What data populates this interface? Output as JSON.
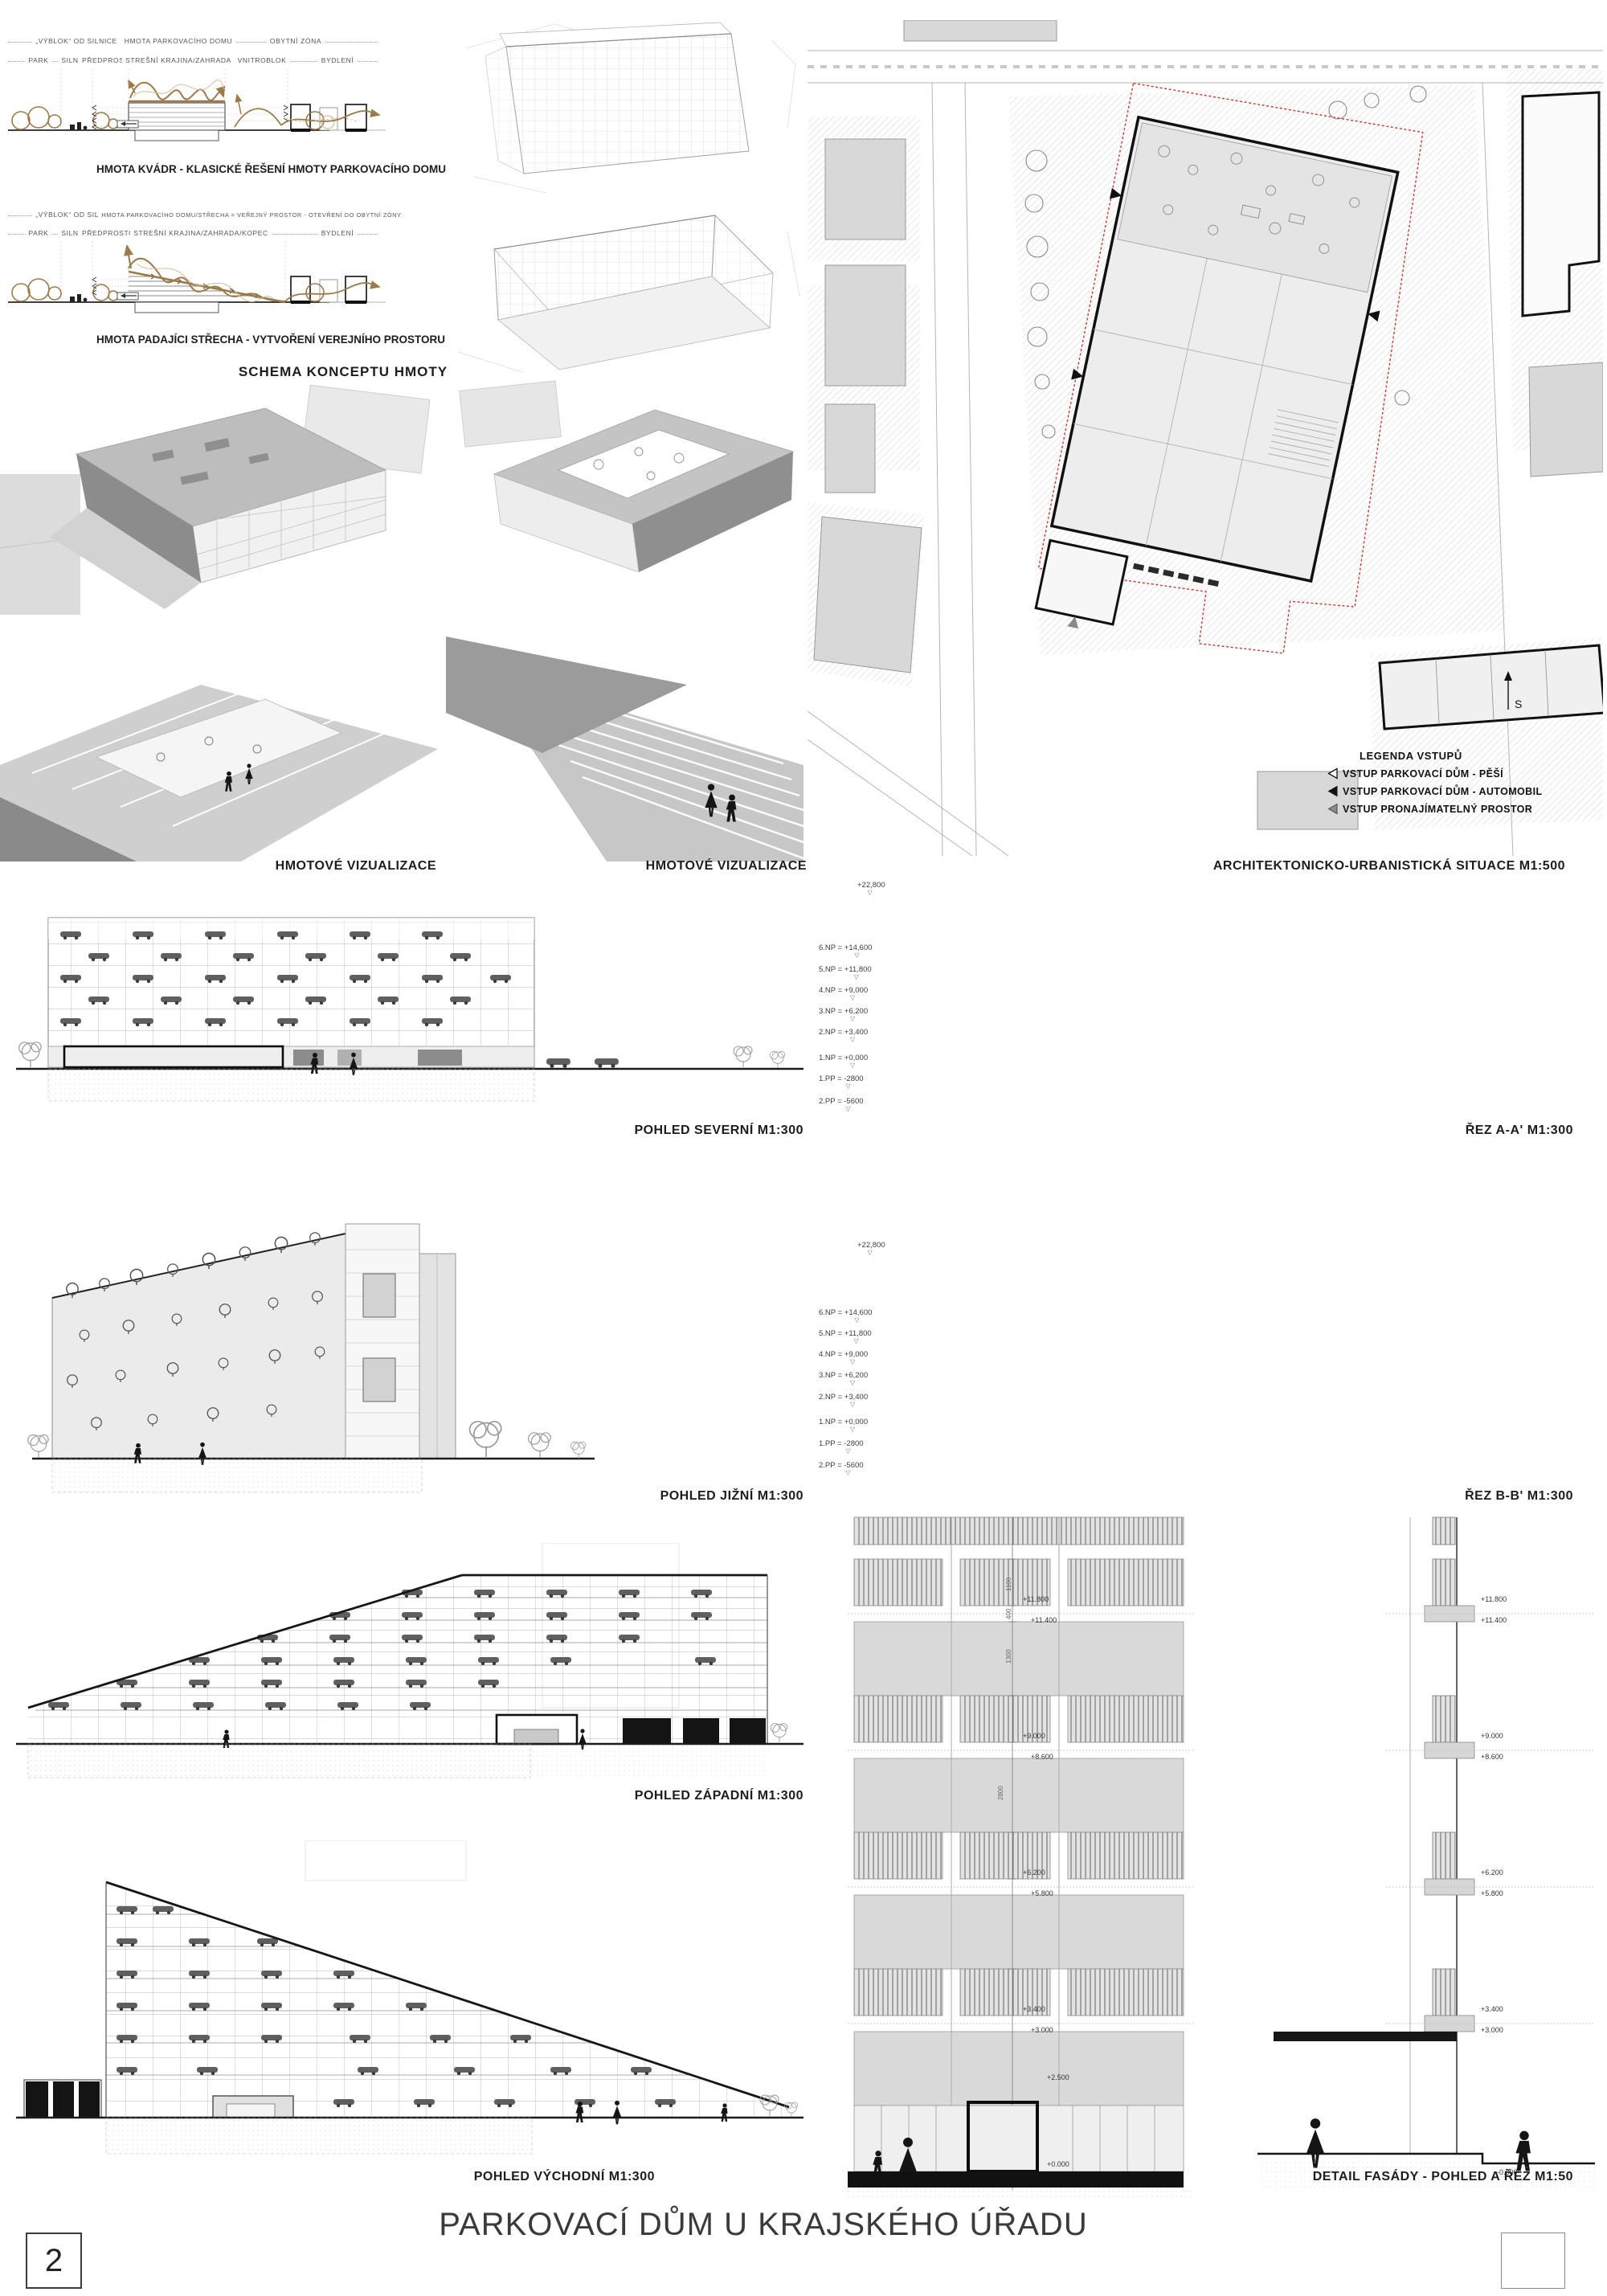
{
  "board": {
    "number": "2",
    "title": "PARKOVACÍ DŮM U KRAJSKÉHO ÚŘADU"
  },
  "concept": {
    "title": "SCHEMA KONCEPTU HMOTY",
    "diagram1": {
      "zones_top": [
        "„VÝBLOK“ OD SILNICE",
        "HMOTA PARKOVACÍHO DOMU",
        "OBYTNÍ ZÓNA"
      ],
      "zones": [
        "PARK",
        "SILNICE",
        "PŘEDPROSTOR",
        "STREŠNÍ KRAJINA/ZAHRADA",
        "VNITROBLOK",
        "BYDLENÍ"
      ],
      "caption": "HMOTA KVÁDR - KLASICKÉ ŘEŠENÍ HMOTY PARKOVACÍHO DOMU"
    },
    "diagram2": {
      "zones_top": [
        "„VÝBLOK“ OD SILNICE",
        "HMOTA PARKOVACÍHO DOMU/STŘECHA = VEŘEJNÝ PROSTOR - OTEVŘENÍ DO OBYTNÍ ZÓNY"
      ],
      "zones": [
        "PARK",
        "SILNICE",
        "PŘEDPROSTOR",
        "STREŠNÍ KRAJINA/ZAHRADA/KOPEC",
        "BYDLENÍ"
      ],
      "caption": "HMOTA PADAJÍCI STŘECHA - VYTVOŘENÍ VEREJNÍHO PROSTORU"
    }
  },
  "visualizations": {
    "caption_left": "HMOTOVÉ VIZUALIZACE",
    "caption_right": "HMOTOVÉ VIZUALIZACE"
  },
  "siteplan": {
    "caption": "ARCHITEKTONICKO-URBANISTICKÁ SITUACE M1:500",
    "north_label": "S",
    "legend": {
      "title": "LEGENDA VSTUPŮ",
      "items": [
        {
          "marker": "triangle-outline",
          "label": "VSTUP PARKOVACÍ DŮM - PĚŠÍ"
        },
        {
          "marker": "triangle-black",
          "label": "VSTUP PARKOVACÍ DŮM - AUTOMOBIL"
        },
        {
          "marker": "triangle-gray",
          "label": "VSTUP PRONAJÍMATELNÝ PROSTOR"
        }
      ]
    }
  },
  "elevations": {
    "north": "POHLED SEVERNÍ M1:300",
    "south": "POHLED JIŽNÍ M1:300",
    "west": "POHLED ZÁPADNÍ M1:300",
    "east": "POHLED VÝCHODNÍ M1:300"
  },
  "sections": {
    "a_caption": "ŘEZ A-A' M1:300",
    "b_caption": "ŘEZ B-B' M1:300",
    "levels": [
      "+22,800",
      "6.NP = +14,600",
      "5.NP = +11,800",
      "4.NP = +9,000",
      "3.NP = +6,200",
      "2.NP = +3,400",
      "1.NP = +0,000",
      "1.PP = -2800",
      "2.PP = -5600"
    ]
  },
  "detail": {
    "caption": "DETAIL FASÁDY - POHLED A ŘEZ M1:50",
    "facade_levels": [
      "+11.800",
      "+11.400",
      "+9.000",
      "+8.600",
      "+6.200",
      "+5.800",
      "+3.400",
      "+3.000",
      "+2.500",
      "+0.000"
    ],
    "section_levels": [
      "+11.800",
      "+11.400",
      "+9.000",
      "+8.600",
      "+6.200",
      "+5.800",
      "+3.400",
      "+3.000",
      "-0.500"
    ],
    "dims": [
      "1100",
      "400",
      "1300",
      "2800"
    ]
  },
  "colors": {
    "accent_brown": "#9a7b4a",
    "boundary_red": "#c43b2e",
    "drawing_gray": "#9e9e9e"
  }
}
